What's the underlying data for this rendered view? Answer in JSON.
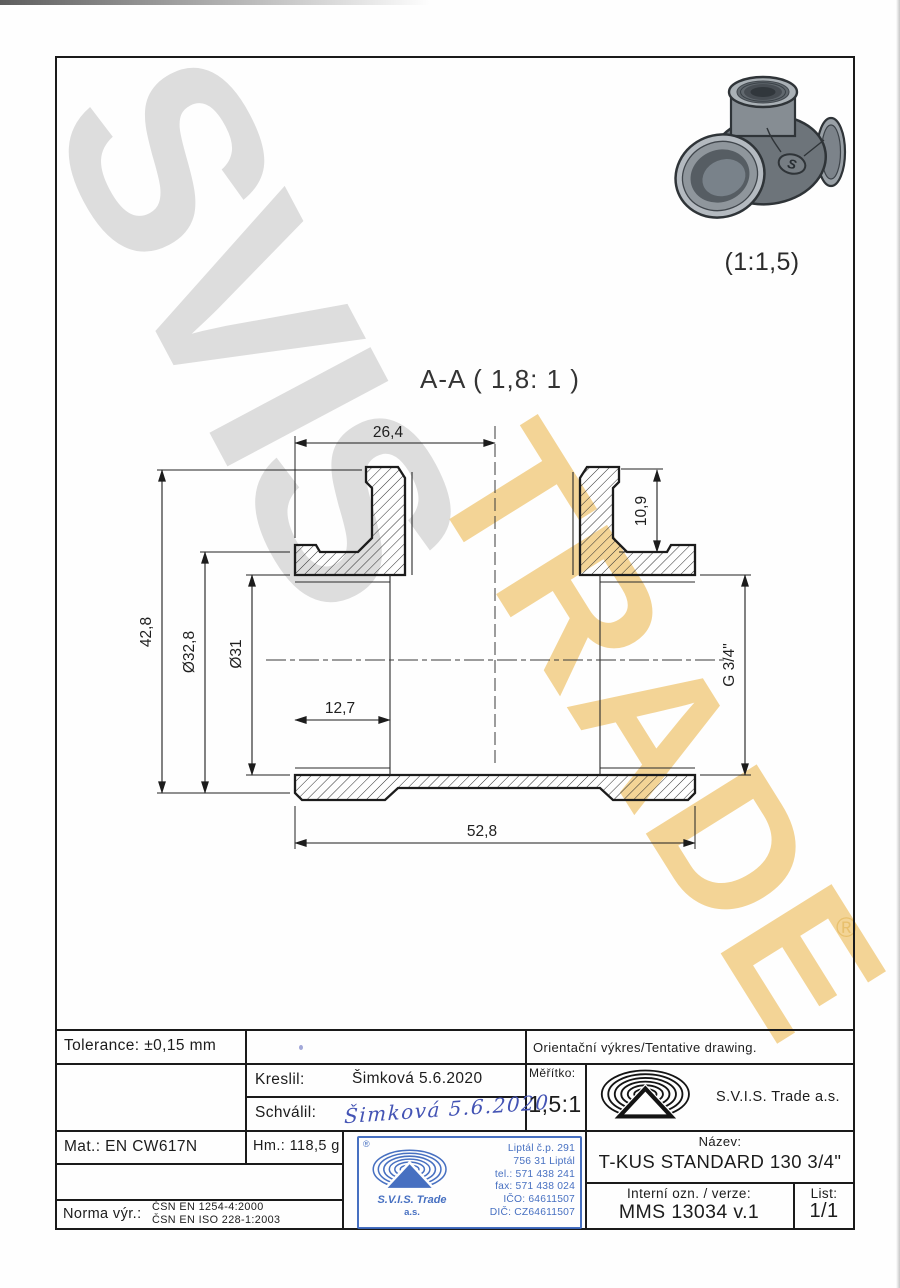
{
  "colors": {
    "line": "#1c1c1c",
    "stamp_blue": "#3a66bd",
    "signature_blue": "#4353b4",
    "watermark_gray": "#c9c9c9",
    "watermark_gold": "#f1c979"
  },
  "watermark": {
    "word_gray": "SVIS",
    "word_gold": "TRADE",
    "registered": "®"
  },
  "photo": {
    "scale_label": "(1:1,5)",
    "badge_letter": "S"
  },
  "section_view": {
    "title": "A-A ( 1,8: 1 )",
    "dims": {
      "top_width": "26,4",
      "branch_depth": "10,9",
      "overall_height": "42,8",
      "outer_dia": "Ø32,8",
      "bore_dia": "Ø31",
      "thread_depth": "12,7",
      "thread_size": "G 3/4\"",
      "overall_length": "52,8"
    }
  },
  "title_block": {
    "tolerance_label": "Tolerance:",
    "tolerance_value": "±0,15 mm",
    "note": "Orientační výkres/Tentative drawing.",
    "kreslil_label": "Kreslil:",
    "kreslil_value": "Šimková 5.6.2020",
    "schvalil_label": "Schválil:",
    "schvalil_signature": "Šimková 5.6.2020",
    "meritko_label": "Měřítko:",
    "meritko_value": "1,5:1",
    "company": "S.V.I.S. Trade a.s.",
    "mat_label": "Mat.:",
    "mat_value": "EN CW617N",
    "hm_label": "Hm.:",
    "hm_value": "118,5 g",
    "norma_label": "Norma výr.:",
    "norma_line1": "ČSN EN 1254-4:2000",
    "norma_line2": "ČSN EN ISO 228-1:2003",
    "nazev_label": "Název:",
    "nazev_value": "T-KUS STANDARD 130 3/4\"",
    "interni_label": "Interní ozn. / verze:",
    "interni_value": "MMS 13034 v.1",
    "list_label": "List:",
    "list_value": "1/1",
    "stamp": {
      "registered": "®",
      "company_line1": "S.V.I.S. Trade",
      "company_line2": "a.s.",
      "address1": "Liptál č.p. 291",
      "address2": "756 31 Liptál",
      "tel": "tel.: 571 438 241",
      "fax": "fax: 571 438 024",
      "ico": "IČO: 64611507",
      "dic": "DIČ: CZ64611507"
    }
  }
}
